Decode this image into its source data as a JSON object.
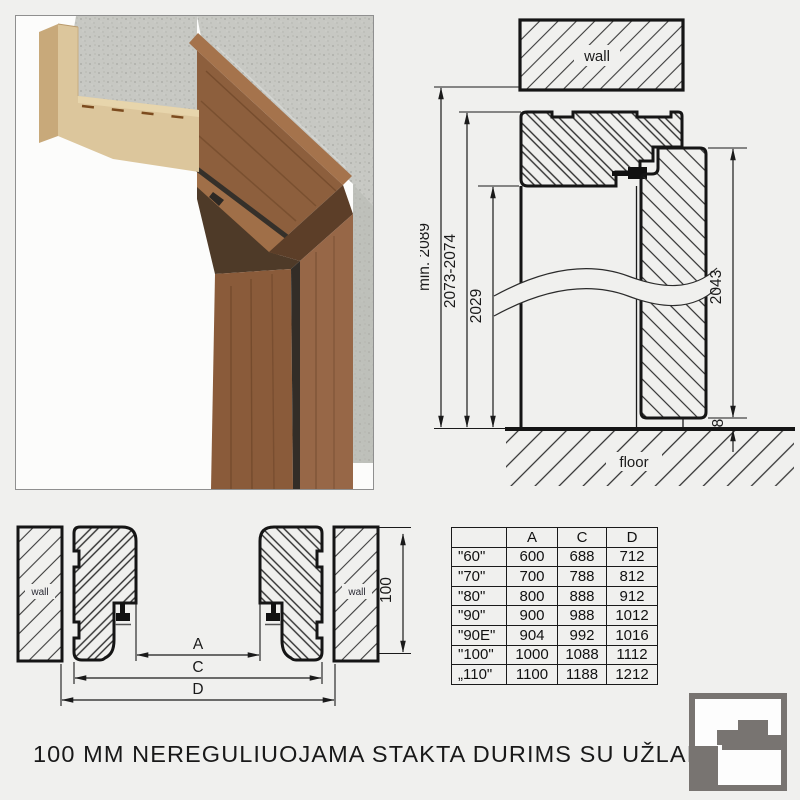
{
  "page": {
    "background": "#f0f0ee",
    "caption": "100 MM NEREGULIUOJAMA STAKTA DURIMS SU UŽLAIDA"
  },
  "vertical_section": {
    "wall_label": "wall",
    "floor_label": "floor",
    "dims": {
      "total": "min. 2089",
      "frame": "2073-2074",
      "clear": "2029",
      "leaf": "2043",
      "gap": "8"
    }
  },
  "horizontal_section": {
    "wall_left": "wall",
    "wall_right": "wall",
    "dims": {
      "a": "A",
      "c": "C",
      "d": "D",
      "depth": "100"
    }
  },
  "size_table": {
    "columns": [
      "",
      "A",
      "C",
      "D"
    ],
    "rows": [
      {
        "size": "\"60\"",
        "a": "600",
        "c": "688",
        "d": "712"
      },
      {
        "size": "\"70\"",
        "a": "700",
        "c": "788",
        "d": "812"
      },
      {
        "size": "\"80\"",
        "a": "800",
        "c": "888",
        "d": "912"
      },
      {
        "size": "\"90\"",
        "a": "900",
        "c": "988",
        "d": "1012"
      },
      {
        "size": "\"90E\"",
        "a": "904",
        "c": "992",
        "d": "1016"
      },
      {
        "size": "\"100\"",
        "a": "1000",
        "c": "1088",
        "d": "1112"
      },
      {
        "size": "„110\"",
        "a": "1100",
        "c": "1188",
        "d": "1212"
      }
    ]
  },
  "logo": {
    "color": "#787471"
  }
}
